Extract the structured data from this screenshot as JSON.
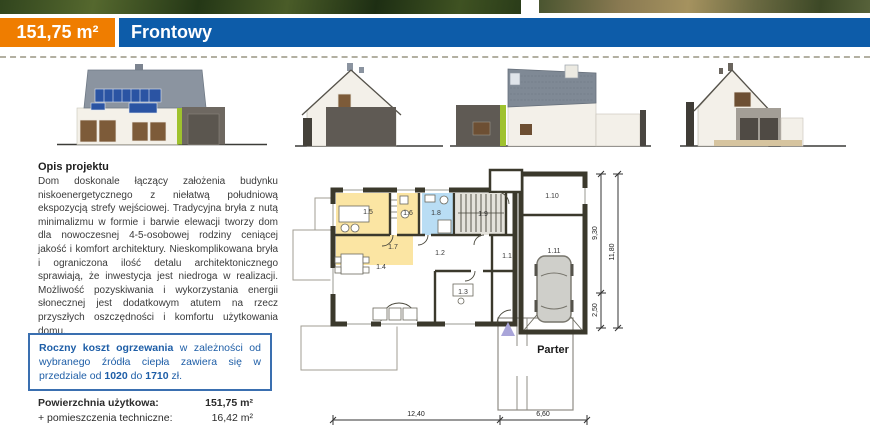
{
  "header": {
    "area_badge": "151,75 m²",
    "variant_name": "Frontowy"
  },
  "description": {
    "heading": "Opis projektu",
    "body": "Dom doskonale łączący założenia budynku niskoenergetycznego z niełatwą południową ekspozycją strefy wejściowej. Tradycyjna bryła z nutą minimalizmu w formie i barwie elewacji tworzy dom dla nowoczesnej 4-5-osobowej rodziny ceniącej jakość i komfort architektury. Nieskomplikowana bryła i ograniczona ilość detalu architektonicznego sprawiają, że inwestycja jest niedroga w realizacji. Możliwość pozyskiwania i wykorzystania energii słonecznej jest dodatkowym atutem na rzecz przyszłych oszczędności i komfortu użytkowania domu."
  },
  "cost_box": {
    "lead_bold": "Roczny koszt ogrzewania",
    "t1": " w zależności od wybranego źródła ciepła zawiera się w przedziale od ",
    "low": "1020",
    "t2": " do ",
    "high": "1710",
    "t3": " zł."
  },
  "areas": {
    "rows": [
      {
        "label": "Powierzchnia użytkowa:",
        "value": "151,75 m²"
      },
      {
        "label": "+ pomieszczenia techniczne:",
        "value": "16,42 m²"
      }
    ]
  },
  "plan": {
    "title": "Parter",
    "rooms": {
      "r1_1": "1.1",
      "r1_2": "1.2",
      "r1_3": "1.3",
      "r1_4": "1.4",
      "r1_5": "1.5",
      "r1_6": "1.6",
      "r1_7": "1.7",
      "r1_8": "1.8",
      "r1_9": "1.9",
      "r1_10": "1.10",
      "r1_11": "1.11"
    },
    "dimensions": {
      "bottom_main": "12,40",
      "bottom_side": "6,60",
      "right_upper": "9,30",
      "right_lower": "2,50",
      "right_total": "11,80"
    }
  },
  "colors": {
    "accent_orange": "#ef7d00",
    "accent_blue": "#0d5ca9",
    "cost_text": "#1e5ea7",
    "plan_wall": "#3b392c",
    "room_yellow": "#fbe5a3",
    "room_blue": "#b9ddf4",
    "room_gray": "#e4e2db",
    "floor_cream": "#f9f1dc",
    "roof_gray": "#8b94a0",
    "solar_blue": "#2b54a3",
    "eco_green": "#9fc22e"
  }
}
